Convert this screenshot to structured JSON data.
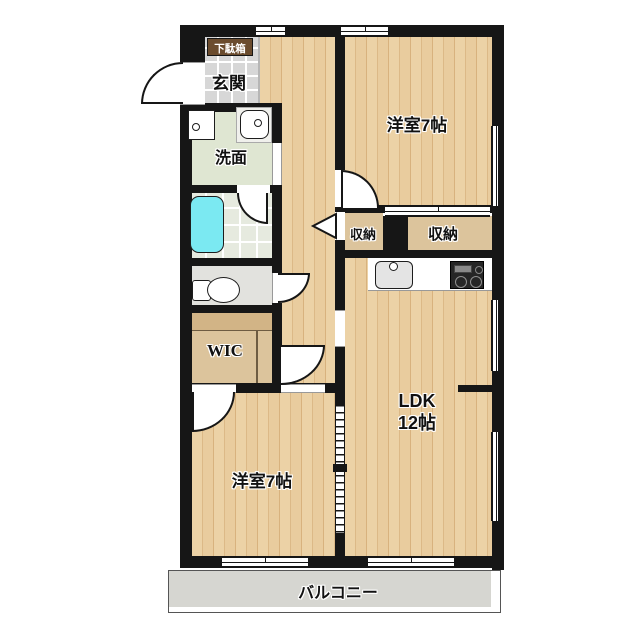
{
  "plan": {
    "type": "apartment-floor-plan",
    "rooms": {
      "entrance": {
        "label": "玄関"
      },
      "shoe_cabinet": {
        "label": "下駄箱"
      },
      "washroom": {
        "label": "洗面"
      },
      "wic": {
        "label": "WIC"
      },
      "closet_small": {
        "label": "収納"
      },
      "closet_large": {
        "label": "収納"
      },
      "bedroom_top": {
        "label": "洋室7帖"
      },
      "bedroom_bottom": {
        "label": "洋室7帖"
      },
      "ldk": {
        "label_line1": "LDK",
        "label_line2": "12帖"
      },
      "balcony": {
        "label": "バルコニー"
      }
    },
    "colors": {
      "wall": "#161616",
      "wood_floor": "#ecd2a6",
      "entrance_tile": "#d7d7d7",
      "washroom": "#dfe6d2",
      "bath_tile": "#e6eadf",
      "bathtub": "#7be9f2",
      "closet_tan": "#dcc49c",
      "shoe_cabinet": "#6b4c2e",
      "balcony": "#d6d6d1"
    }
  }
}
